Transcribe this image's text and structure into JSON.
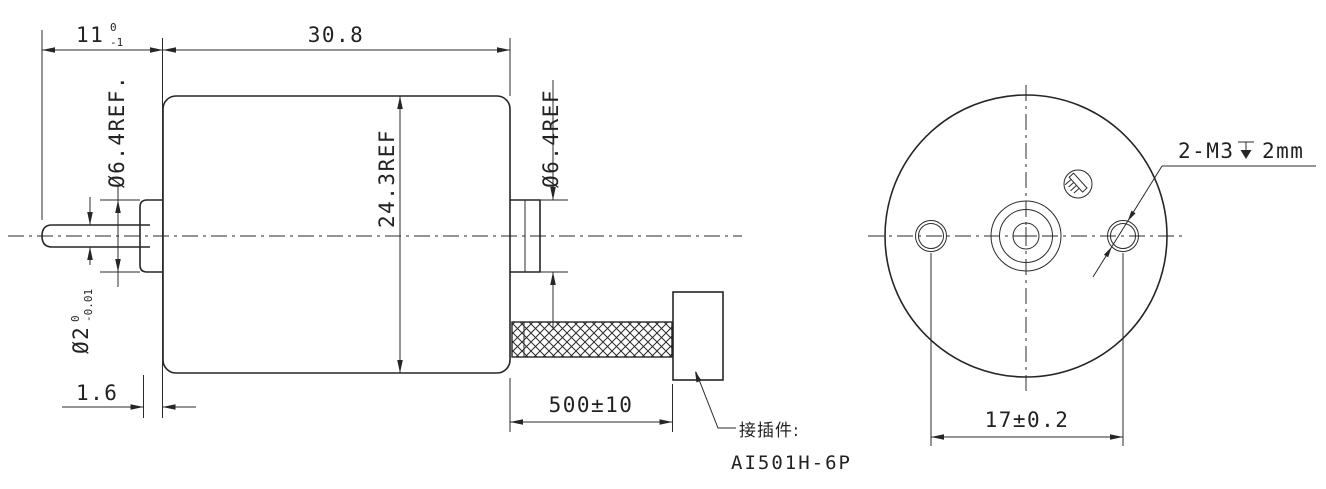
{
  "drawing": {
    "title_hint": "motor-outline-drawing",
    "background": "#ffffff",
    "line_color": "#262626",
    "side_view": {
      "dim_shaft_length": {
        "value": "11",
        "tol_upper": "0",
        "tol_lower": "-1"
      },
      "dim_body_length": {
        "value": "30.8"
      },
      "dim_front_hub_dia": {
        "value": "Ø6.4REF."
      },
      "dim_body_dia": {
        "value": "24.3REF"
      },
      "dim_rear_hub_dia": {
        "value": "Ø6.4REF"
      },
      "dim_shaft_dia": {
        "value": "Ø2",
        "tol_upper": "0",
        "tol_lower": "-0.01"
      },
      "dim_flange_thickness": {
        "value": "1.6"
      },
      "dim_lead_length": {
        "value": "500±10"
      },
      "connector_note": {
        "label": "接插件:",
        "model": "AI501H-6P"
      }
    },
    "end_view": {
      "thread_note": {
        "prefix": "2-M3",
        "suffix": "2mm"
      },
      "dim_mount_hole_spacing": {
        "value": "17±0.2"
      }
    }
  }
}
